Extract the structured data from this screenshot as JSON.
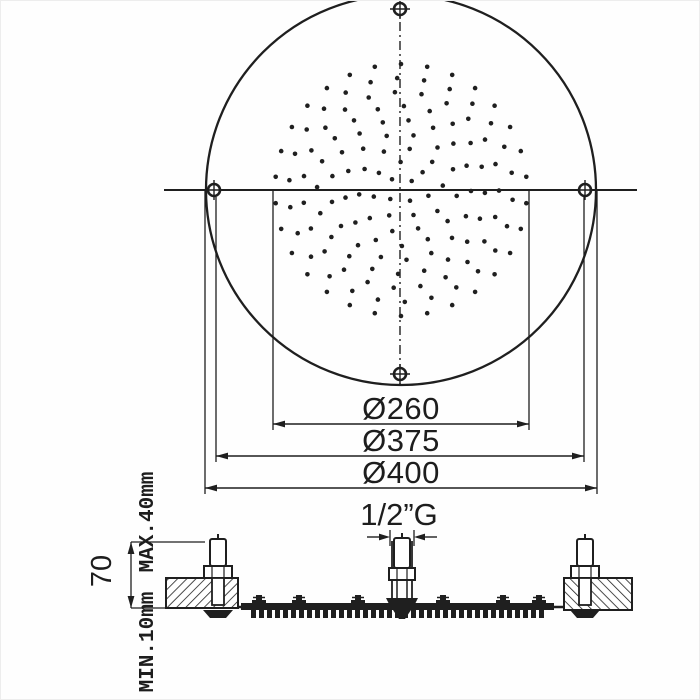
{
  "colors": {
    "ink": "#1f1f1f",
    "background": "#ffffff"
  },
  "top_view": {
    "dim_nozzle_field_label": "Ø260",
    "dim_screw_circle_label": "Ø375",
    "dim_outer_label": "Ø400",
    "nozzle_rings": [
      {
        "r": 14,
        "count": 4,
        "offset": 50
      },
      {
        "r": 28,
        "count": 7,
        "offset": 12
      },
      {
        "r": 42,
        "count": 10,
        "offset": 30
      },
      {
        "r": 56,
        "count": 13,
        "offset": 6
      },
      {
        "r": 70,
        "count": 17,
        "offset": 22
      },
      {
        "r": 84,
        "count": 20,
        "offset": 2
      },
      {
        "r": 98,
        "count": 23,
        "offset": 16
      },
      {
        "r": 112,
        "count": 26,
        "offset": 5
      },
      {
        "r": 126,
        "count": 30,
        "offset": 18
      }
    ]
  },
  "section_view": {
    "pipe_thread_label": "1/2”G",
    "height_label": "70",
    "panel_max_label": "MAX.40mm",
    "panel_min_label": "MIN.10mm"
  }
}
